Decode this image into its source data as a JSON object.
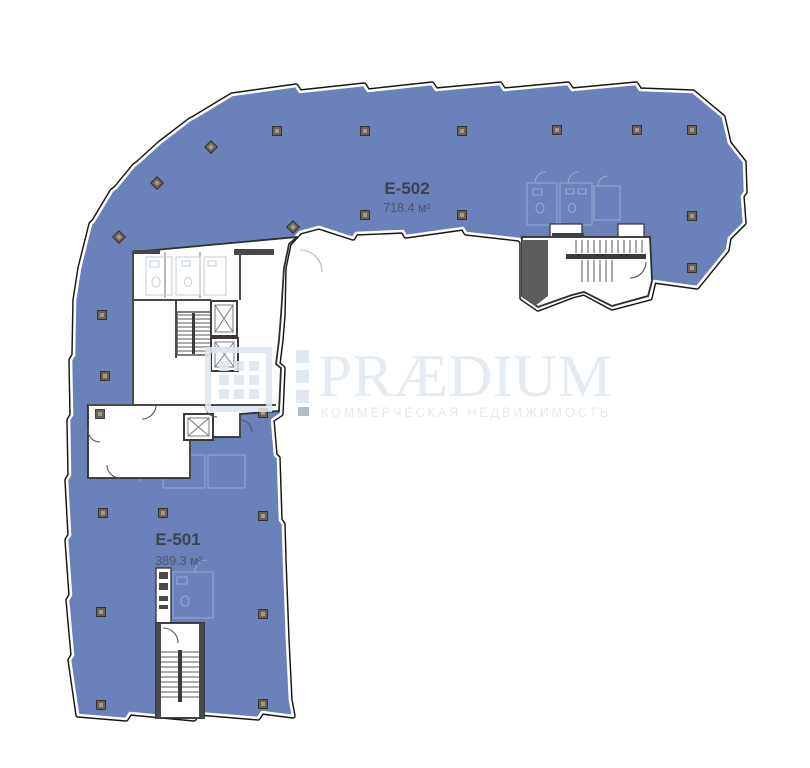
{
  "plan": {
    "units": [
      {
        "id": "E-502",
        "label": "E-502",
        "area": "718.4 м²"
      },
      {
        "id": "E-501",
        "label": "E-501",
        "area": "389.3 м²"
      }
    ],
    "colors": {
      "floor_fill": "#6A81B9",
      "outline": "#161616",
      "inner_gap": "#FFFFFF",
      "ghost_line": "#9DB0D4",
      "wall": "#4A4A4A",
      "column_marker": "#6B6453",
      "unit_label_text": "#3D4450",
      "unit_area_text": "#4E586C",
      "watermark": "#DDE5EF"
    }
  },
  "watermark": {
    "brand": "PRÆDIUM",
    "tagline": "КОММЕРЧЕСКАЯ НЕДВИЖИМОСТЬ"
  }
}
